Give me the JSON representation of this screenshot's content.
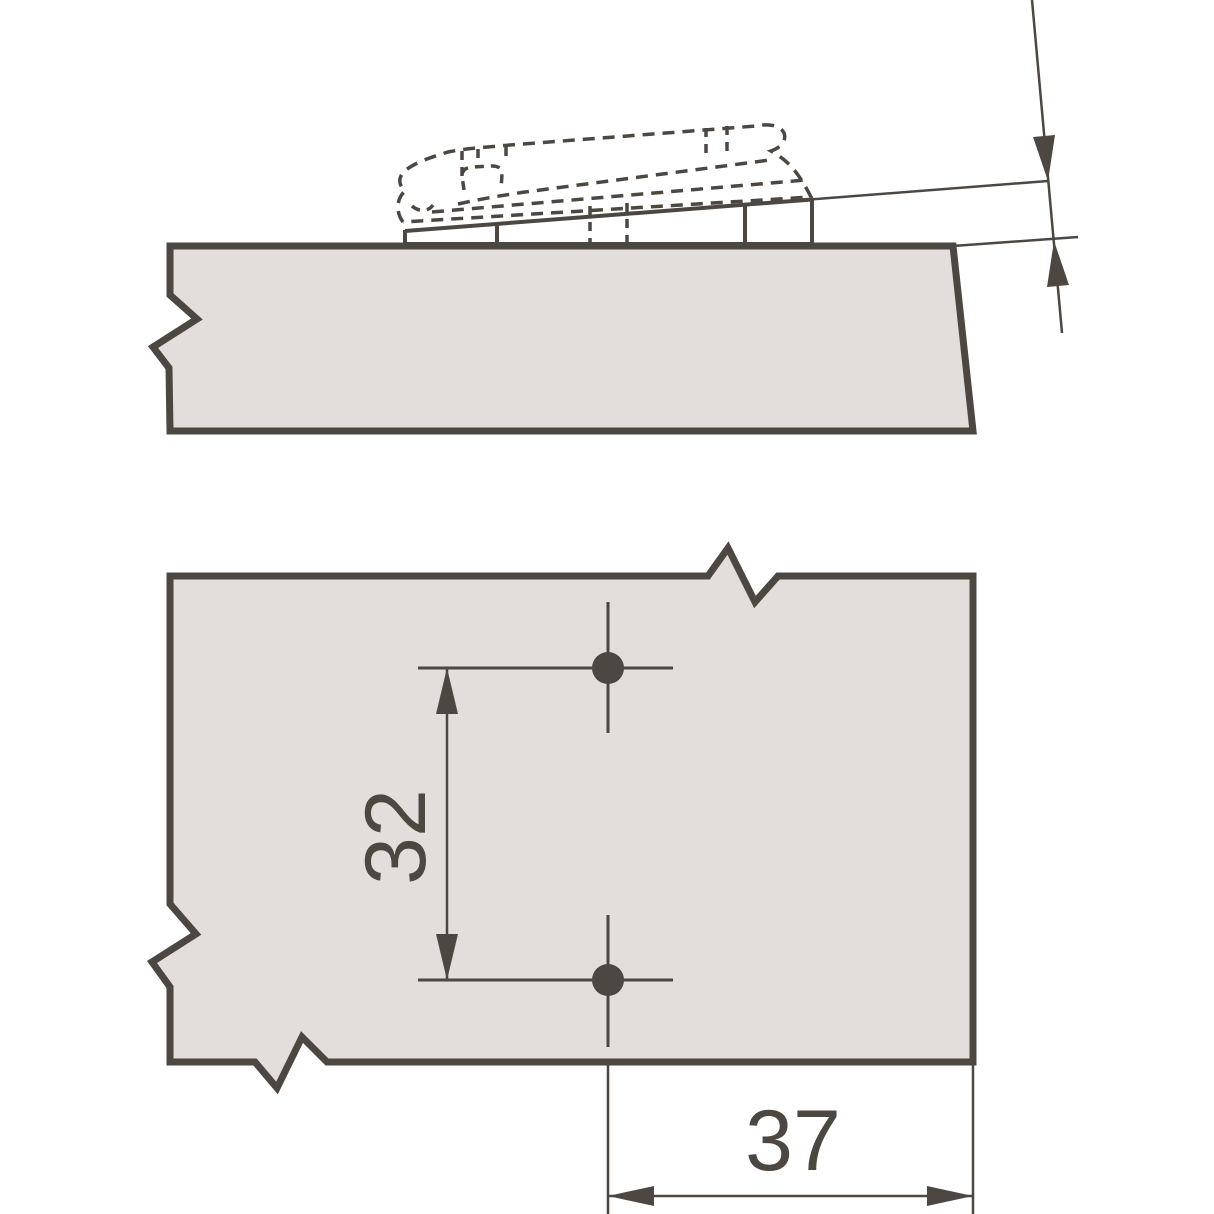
{
  "drawing": {
    "plan_view": {
      "hole_spacing_label": "32",
      "edge_distance_label": "37"
    },
    "colors": {
      "line": "#4d4742",
      "panel_fill": "#e2dedc",
      "background": "#ffffff"
    }
  }
}
